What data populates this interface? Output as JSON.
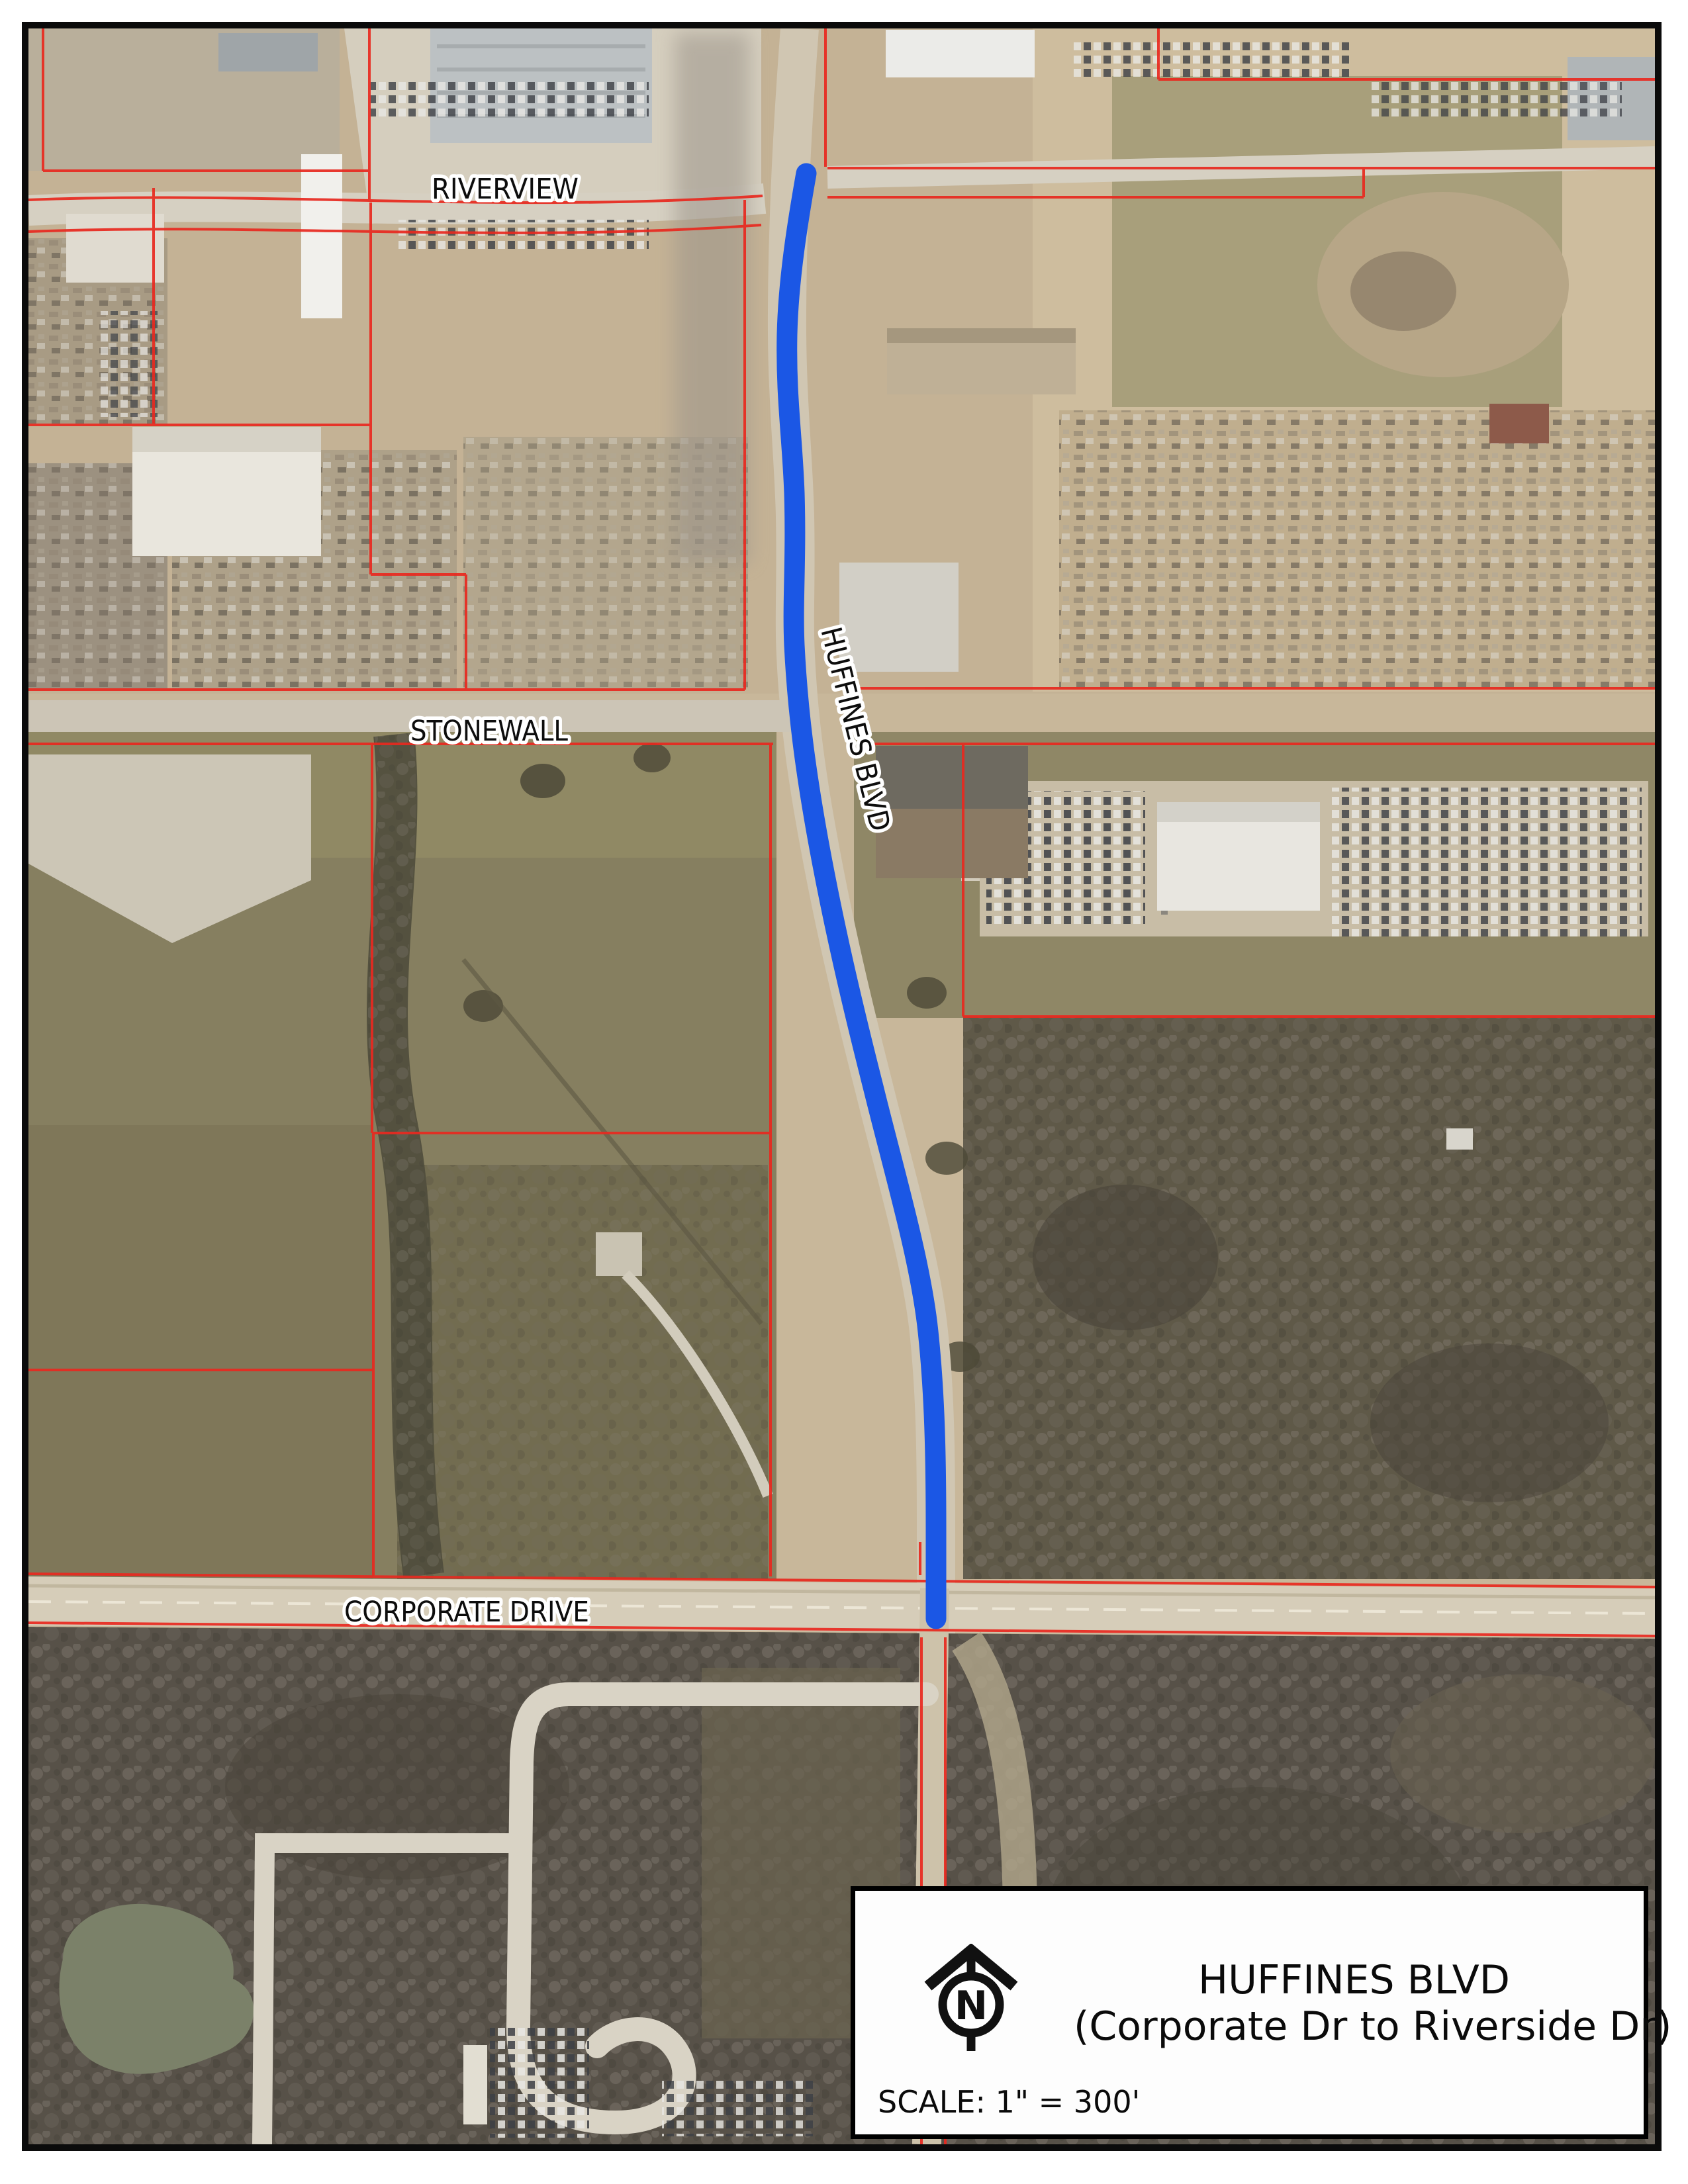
{
  "map_labels": {
    "riverview": "RIVERVIEW",
    "stonewall": "STONEWALL",
    "corporate_drive": "CORPORATE DRIVE",
    "huffines_blvd": "HUFFINES BLVD"
  },
  "colors": {
    "route_highlight": "#1b57e5",
    "parcel_lines": "#e8291f"
  },
  "title_block": {
    "title": "HUFFINES BLVD",
    "subtitle": "(Corporate Dr to Riverside Dr)",
    "scale": "SCALE: 1\" = 300'",
    "north": "N"
  }
}
